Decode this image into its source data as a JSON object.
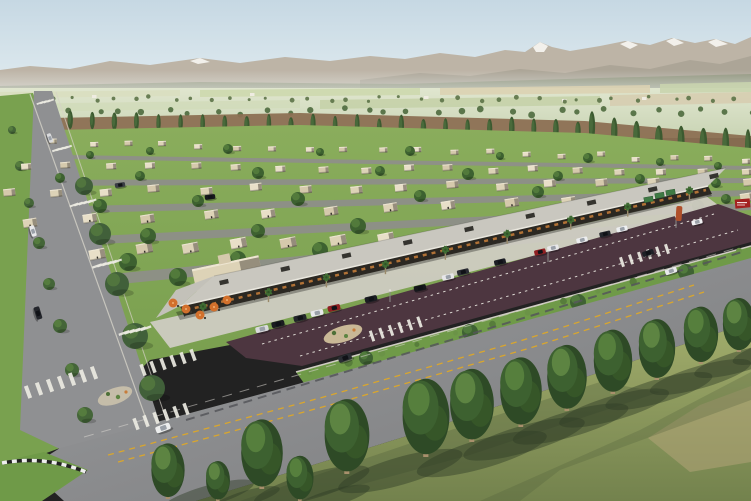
{
  "scene": {
    "title": "aerial-rendering-residential-community",
    "description": "Aerial architectural rendering of a desert-valley master-planned community: snow-capped mountains and farmland in the distance, a poplar windbreak row, a grid of flat-roofed beige single-story houses with lawns and trees, a long retail strip with a flat canopy roof, palm trees and an orange-umbrella patio, a maroon parking lot with cars, a wide boulevard with yellow dashed markings and crosswalks, and a foreground row of tall green trees casting long shadows on grass."
  },
  "palette": {
    "sky_top": "#c6d8e3",
    "sky_bottom": "#e3edf1",
    "mountain": "#bdb4a6",
    "mountain_near": "#a8a193",
    "snow": "#f4f3ee",
    "valley_light": "#e0e6cf",
    "valley_dark": "#c9d4b4",
    "field_tan": "#d8cfae",
    "tilled_brown": "#8c7053",
    "tree_dark": "#2e4a26",
    "tree_mid": "#3d6130",
    "tree_light": "#567f3d",
    "poplar": "#3c5a30",
    "poplar_light": "#4e7040",
    "trunk": "#a8906c",
    "grass_res": "#7da253",
    "grass_fg": "#96a363",
    "road": "#8f9092",
    "asphalt_dark": "#6f7072",
    "marking_white": "#eceae2",
    "marking_yellow": "#d9a62e",
    "sidewalk": "#cfccc2",
    "house_wall": "#ddd3b7",
    "house_wall_alt": "#e8dfc8",
    "house_wall_alt2": "#d5c9ac",
    "house_shadow": "#8a8172",
    "canopy_roof": "#c9c7bf",
    "storefront": "#2b2822",
    "light_warm": "#c07a38",
    "parking_asphalt": "#4d3640",
    "verge_green": "#6f9a48",
    "bush": "#577d3b",
    "umbrella_orange": "#d2702c",
    "sign_red": "#a32020",
    "sculpture_orange": "#b0502a",
    "canopy_green": "#3f7a44",
    "car_white": "#e9eaec",
    "car_black": "#1d2026",
    "car_red": "#8f1f22"
  },
  "poplar_rows": [
    {
      "x0": 4,
      "y0": 128,
      "x1": 578,
      "y1": 141,
      "n": 27,
      "h0": 15,
      "h1": 19,
      "w": 5
    },
    {
      "x0": 592,
      "y0": 142,
      "x1": 748,
      "y1": 167,
      "n": 8,
      "h0": 24,
      "h1": 32,
      "w": 7
    }
  ],
  "valley_tree_rows": [
    {
      "x0": 0,
      "x1": 751,
      "y0": 97,
      "y1": 102,
      "n": 40,
      "r0": 1.5,
      "r1": 2.5
    },
    {
      "x0": 0,
      "x1": 751,
      "y0": 109,
      "y1": 115,
      "n": 32,
      "r0": 2.5,
      "r1": 3.5
    }
  ],
  "farm_buildings": [
    [
      30,
      98
    ],
    [
      92,
      95
    ],
    [
      250,
      93
    ],
    [
      424,
      96
    ],
    [
      562,
      99
    ],
    [
      642,
      97
    ]
  ],
  "house_rows": [
    {
      "x0": 55,
      "y0": 143,
      "x1": 745,
      "y1": 160,
      "n": 20,
      "s": 0.5,
      "rot": -2
    },
    {
      "x0": 25,
      "y0": 167,
      "x1": 748,
      "y1": 171,
      "n": 18,
      "s": 0.62,
      "rot": -4
    },
    {
      "x0": 8,
      "y0": 193,
      "x1": 750,
      "y1": 182,
      "n": 16,
      "s": 0.74,
      "rot": -6
    },
    {
      "x0": 30,
      "y0": 222,
      "x1": 750,
      "y1": 196,
      "n": 13,
      "s": 0.86,
      "rot": -9
    },
    {
      "x0": 95,
      "y0": 252,
      "x1": 432,
      "y1": 236,
      "n": 8,
      "s": 1.0,
      "rot": -11
    }
  ],
  "res_trees": [
    [
      90,
      155,
      4
    ],
    [
      150,
      151,
      4
    ],
    [
      228,
      149,
      5
    ],
    [
      320,
      152,
      4
    ],
    [
      410,
      151,
      5
    ],
    [
      500,
      156,
      4
    ],
    [
      588,
      158,
      5
    ],
    [
      660,
      162,
      4
    ],
    [
      718,
      166,
      4
    ],
    [
      60,
      178,
      5
    ],
    [
      140,
      176,
      5
    ],
    [
      258,
      173,
      6
    ],
    [
      380,
      171,
      5
    ],
    [
      468,
      174,
      6
    ],
    [
      558,
      176,
      5
    ],
    [
      640,
      179,
      5
    ],
    [
      716,
      183,
      5
    ],
    [
      100,
      206,
      7
    ],
    [
      198,
      201,
      6
    ],
    [
      298,
      199,
      7
    ],
    [
      420,
      196,
      6
    ],
    [
      538,
      192,
      6
    ],
    [
      648,
      196,
      6
    ],
    [
      726,
      199,
      5
    ],
    [
      148,
      236,
      8
    ],
    [
      258,
      231,
      7
    ],
    [
      358,
      226,
      8
    ],
    [
      698,
      206,
      6
    ],
    [
      128,
      262,
      9
    ],
    [
      238,
      259,
      8
    ],
    [
      250,
      272,
      10
    ],
    [
      178,
      277,
      9
    ],
    [
      320,
      250,
      8
    ]
  ],
  "median_trees": [
    [
      84,
      186,
      9
    ],
    [
      100,
      234,
      11
    ],
    [
      117,
      284,
      12
    ],
    [
      135,
      336,
      13
    ],
    [
      152,
      388,
      13
    ]
  ],
  "verge_left_trees": [
    [
      12,
      130,
      4
    ],
    [
      20,
      166,
      5
    ],
    [
      29,
      203,
      5
    ],
    [
      39,
      243,
      6
    ],
    [
      49,
      284,
      6
    ],
    [
      60,
      326,
      7
    ],
    [
      72,
      370,
      7
    ],
    [
      85,
      415,
      8
    ]
  ],
  "commercial": {
    "columns": {
      "x0": 184,
      "y0": 314,
      "x1": 708,
      "y1": 192,
      "n": 16
    },
    "ac_units": {
      "x0": 224,
      "y0": 282,
      "x1": 714,
      "y1": 176,
      "n": 9
    },
    "palms": {
      "x0": 206,
      "y0": 318,
      "x1": 690,
      "y1": 202,
      "n": 9
    },
    "umbrellas": [
      [
        173,
        303
      ],
      [
        186,
        309
      ],
      [
        200,
        315
      ],
      [
        214,
        307
      ],
      [
        227,
        300
      ]
    ]
  },
  "parking_cars": [
    [
      300,
      318,
      -13,
      "#23252b"
    ],
    [
      317,
      313,
      -13,
      "#e8e9eb"
    ],
    [
      334,
      308,
      -13,
      "#8f1f22"
    ],
    [
      371,
      299,
      -13,
      "#1b1d22"
    ],
    [
      420,
      288,
      -13,
      "#15171b"
    ],
    [
      448,
      277,
      -13,
      "#e6e6e8"
    ],
    [
      463,
      272,
      -13,
      "#2a2c33"
    ],
    [
      500,
      262,
      -13,
      "#1c1e24"
    ],
    [
      540,
      252,
      -13,
      "#8f1f22"
    ],
    [
      553,
      248,
      -13,
      "#e8e8ea"
    ],
    [
      582,
      240,
      -13,
      "#ecedef"
    ],
    [
      605,
      234,
      -13,
      "#23262c"
    ],
    [
      622,
      229,
      -13,
      "#edeff1"
    ],
    [
      278,
      324,
      -13,
      "#1a1c20"
    ],
    [
      262,
      329,
      -13,
      "#d9dadc"
    ]
  ],
  "light_poles": [
    [
      390,
      302
    ],
    [
      548,
      262
    ],
    [
      676,
      228
    ]
  ],
  "bushes": {
    "x0": 312,
    "y0": 374,
    "x1": 742,
    "y1": 252,
    "n": 13,
    "r": 3
  },
  "verge_trees": [
    [
      366,
      358,
      7
    ],
    [
      470,
      332,
      8
    ],
    [
      578,
      302,
      8
    ],
    [
      686,
      272,
      8
    ]
  ],
  "road_cars": [
    [
      163,
      428,
      -20,
      "#eceded"
    ],
    [
      345,
      358,
      -20,
      "#2a2d33"
    ],
    [
      648,
      253,
      -18,
      "#1d2026"
    ],
    [
      671,
      271,
      -18,
      "#e9eaec"
    ],
    [
      697,
      222,
      -14,
      "#f1f1f3"
    ],
    [
      38,
      313,
      73,
      "#24262c"
    ],
    [
      33,
      231,
      73,
      "#e7e8ea"
    ],
    [
      50,
      138,
      70,
      "#d9dadc"
    ],
    [
      210,
      197,
      -8,
      "#16181c"
    ],
    [
      120,
      185,
      -8,
      "#3a3d44"
    ]
  ],
  "crosswalks": [
    [
      28,
      392,
      7,
      11,
      -3.2,
      4,
      13,
      -20
    ],
    [
      136,
      424,
      6,
      10,
      -3,
      3.5,
      12,
      -20
    ],
    [
      143,
      370,
      6,
      10,
      -3,
      3.5,
      12,
      -20
    ],
    [
      372,
      336,
      6,
      9.5,
      -2.8,
      3,
      11,
      -19
    ],
    [
      622,
      262,
      6,
      9,
      -2.6,
      3,
      10,
      -18
    ],
    [
      40,
      103,
      4,
      3.5,
      -0.8,
      1.8,
      7,
      70
    ],
    [
      56,
      150,
      4,
      4,
      -1,
      2,
      8,
      70
    ],
    [
      74,
      205,
      5,
      4.5,
      -1,
      2,
      9,
      70
    ],
    [
      97,
      266,
      5,
      5,
      -1.2,
      2.2,
      10,
      70
    ],
    [
      124,
      333,
      5,
      5.5,
      -1.2,
      2.4,
      11,
      70
    ]
  ],
  "fg_trees": [
    [
      168,
      499,
      64
    ],
    [
      262,
      489,
      80
    ],
    [
      347,
      474,
      86
    ],
    [
      426,
      457,
      90
    ],
    [
      472,
      442,
      84
    ],
    [
      521,
      427,
      80
    ],
    [
      567,
      411,
      76
    ],
    [
      613,
      394,
      74
    ],
    [
      657,
      380,
      70
    ],
    [
      701,
      364,
      66
    ],
    [
      739,
      352,
      62
    ],
    [
      300,
      501,
      52
    ],
    [
      218,
      501,
      46
    ]
  ]
}
